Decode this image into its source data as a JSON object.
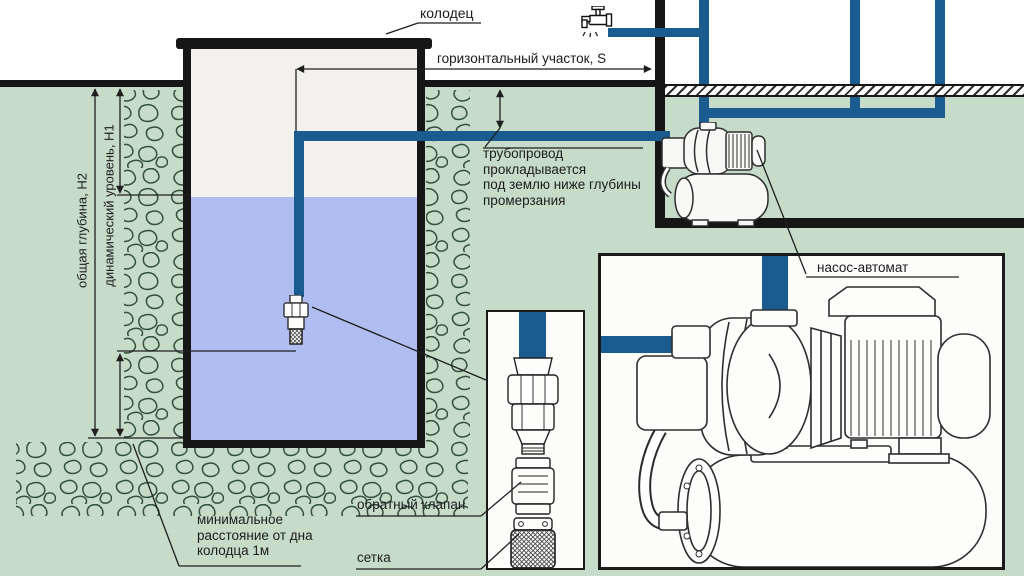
{
  "labels": {
    "well": "колодец",
    "horizontal_section": "горизонтальный участок, S",
    "pipeline_note": "трубопровод\nпрокладывается\nпод землю ниже глубины\nпромерзания",
    "pump_station": "насос-автомат",
    "check_valve": "обратный клапан",
    "strainer": "сетка",
    "min_distance": "минимальное\nрасстояние от дна\nколодца 1м",
    "total_depth": "общая глубина, H2",
    "dynamic_level": "динамический уровень, H1"
  },
  "icons": {
    "tap": "tap-icon",
    "pump_small": "pump-station-small-illustration",
    "pump_detail": "pump-station-detail-illustration",
    "foot_valve": "foot-valve-illustration",
    "check_valve": "check-valve-illustration",
    "strainer": "strainer-illustration"
  },
  "colors": {
    "pipe_blue": "#1a5c90",
    "ground_green": "#c6dbc8",
    "water_blue": "#afbdf0",
    "line_dark": "#1e1e1e",
    "well_interior": "#f2f1ee",
    "stone_outline": "#33503f",
    "text_dark": "#1c1c1c"
  }
}
